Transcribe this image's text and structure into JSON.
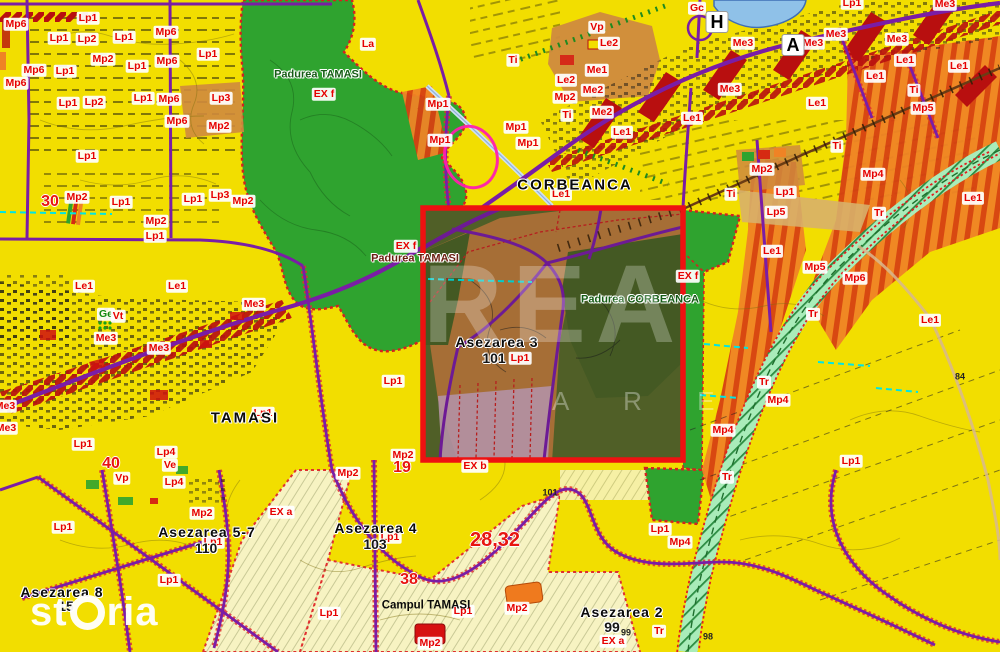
{
  "map_title": "Zoning map Corbeanca / Tamasi with highlighted selection area",
  "colors": {
    "base_yellow": "#f2de00",
    "pale_parcel": "#f7f3c2",
    "forest_green": "#2fa32f",
    "dark_forest_in_selection": "#4c6428",
    "settlement_orange": "#bb7c3d",
    "zone_orange_striped": "#ef8325",
    "corridor_red_hatch": "#b80f0f",
    "road_purple": "#7a1da6",
    "boundary_red_dashed": "#e03030",
    "rail_corridor_mint": "#a9ecb9",
    "water_blue": "#8fc1e8",
    "selection_red": "#ee1111",
    "zone_label_red": "#e60000",
    "utility_cyan": "#00e5e5",
    "pink_parcel": "#c9a3b8"
  },
  "selection_box": {
    "x": 423,
    "y": 208,
    "width": 260,
    "height": 252,
    "color": "#ee1111"
  },
  "watermarks": {
    "storia_prefix": "st",
    "storia_suffix": "ria",
    "storia_full": "storia",
    "rea_main": "REA",
    "rea_sub": "A R E"
  },
  "labels": [
    [
      "Mp6",
      16,
      24,
      "zone"
    ],
    [
      "Mp6",
      166,
      32,
      "zone"
    ],
    [
      "Mp6",
      34,
      70,
      "zone"
    ],
    [
      "Mp6",
      167,
      61,
      "zone"
    ],
    [
      "Mp6",
      16,
      83,
      "zone"
    ],
    [
      "Mp6",
      169,
      99,
      "zone"
    ],
    [
      "Mp6",
      177,
      121,
      "zone"
    ],
    [
      "Mp6",
      855,
      278,
      "zone"
    ],
    [
      "Lp1",
      88,
      18,
      "zone"
    ],
    [
      "Lp1",
      59,
      38,
      "zone"
    ],
    [
      "Lp1",
      124,
      37,
      "zone"
    ],
    [
      "Lp1",
      208,
      54,
      "zone"
    ],
    [
      "Lp1",
      137,
      66,
      "zone"
    ],
    [
      "Lp1",
      65,
      71,
      "zone"
    ],
    [
      "Lp1",
      68,
      103,
      "zone"
    ],
    [
      "Lp1",
      143,
      98,
      "zone"
    ],
    [
      "Lp1",
      87,
      156,
      "zone"
    ],
    [
      "Lp1",
      121,
      202,
      "zone"
    ],
    [
      "Lp1",
      193,
      199,
      "zone"
    ],
    [
      "Lp1",
      155,
      236,
      "zone"
    ],
    [
      "Lp1",
      852,
      3,
      "zone"
    ],
    [
      "Lp1",
      785,
      192,
      "zone"
    ],
    [
      "Lp1",
      393,
      381,
      "zone"
    ],
    [
      "Lp1",
      263,
      413,
      "zone"
    ],
    [
      "Lp1",
      83,
      444,
      "zone"
    ],
    [
      "Lp1",
      63,
      527,
      "zone"
    ],
    [
      "Lp1",
      213,
      542,
      "zone"
    ],
    [
      "Lp1",
      169,
      580,
      "zone"
    ],
    [
      "Lp1",
      329,
      613,
      "zone"
    ],
    [
      "Lp1",
      390,
      537,
      "zone"
    ],
    [
      "Lp1",
      463,
      611,
      "zone"
    ],
    [
      "Lp1",
      660,
      529,
      "zone"
    ],
    [
      "Lp1",
      851,
      461,
      "zone"
    ],
    [
      "Lp1",
      520,
      358,
      "zone"
    ],
    [
      "Lp2",
      87,
      39,
      "zone"
    ],
    [
      "Lp2",
      94,
      102,
      "zone"
    ],
    [
      "Lp3",
      221,
      98,
      "zone"
    ],
    [
      "Lp3",
      220,
      195,
      "zone"
    ],
    [
      "Lp4",
      166,
      452,
      "zone"
    ],
    [
      "Lp4",
      174,
      482,
      "zone"
    ],
    [
      "Lp5",
      776,
      212,
      "zone"
    ],
    [
      "Mp2",
      103,
      59,
      "zone"
    ],
    [
      "Mp2",
      219,
      126,
      "zone"
    ],
    [
      "Mp2",
      77,
      197,
      "zone"
    ],
    [
      "Mp2",
      243,
      201,
      "zone"
    ],
    [
      "Mp2",
      156,
      221,
      "zone"
    ],
    [
      "Mp2",
      565,
      97,
      "zone"
    ],
    [
      "Mp2",
      762,
      169,
      "zone"
    ],
    [
      "Mp2",
      202,
      513,
      "zone"
    ],
    [
      "Mp2",
      348,
      473,
      "zone"
    ],
    [
      "Mp2",
      403,
      455,
      "zone"
    ],
    [
      "Mp2",
      430,
      643,
      "zone"
    ],
    [
      "Mp2",
      517,
      608,
      "zone"
    ],
    [
      "Mp1",
      438,
      104,
      "zone"
    ],
    [
      "Mp1",
      440,
      140,
      "zone"
    ],
    [
      "Mp1",
      516,
      127,
      "zone"
    ],
    [
      "Mp1",
      528,
      143,
      "zone"
    ],
    [
      "Mp4",
      873,
      174,
      "zone"
    ],
    [
      "Mp4",
      778,
      400,
      "zone"
    ],
    [
      "Mp4",
      723,
      430,
      "zone"
    ],
    [
      "Mp4",
      680,
      542,
      "zone"
    ],
    [
      "Mp5",
      923,
      108,
      "zone"
    ],
    [
      "Mp5",
      815,
      267,
      "zone"
    ],
    [
      "Me1",
      597,
      70,
      "zone"
    ],
    [
      "Me2",
      593,
      90,
      "zone"
    ],
    [
      "Me2",
      602,
      112,
      "zone"
    ],
    [
      "Me3",
      945,
      4,
      "zone"
    ],
    [
      "Me3",
      836,
      34,
      "zone"
    ],
    [
      "Me3",
      897,
      39,
      "zone"
    ],
    [
      "Me3",
      813,
      43,
      "zone"
    ],
    [
      "Me3",
      743,
      43,
      "zone"
    ],
    [
      "Me3",
      730,
      89,
      "zone"
    ],
    [
      "Me3",
      254,
      304,
      "zone"
    ],
    [
      "Me3",
      106,
      338,
      "zone"
    ],
    [
      "Me3",
      159,
      348,
      "zone"
    ],
    [
      "Me3",
      5,
      406,
      "zone"
    ],
    [
      "Me3",
      6,
      428,
      "zone"
    ],
    [
      "Le1",
      692,
      118,
      "zone"
    ],
    [
      "Le1",
      622,
      132,
      "zone"
    ],
    [
      "Le1",
      905,
      60,
      "zone"
    ],
    [
      "Le1",
      959,
      66,
      "zone"
    ],
    [
      "Le1",
      875,
      76,
      "zone"
    ],
    [
      "Le1",
      817,
      103,
      "zone"
    ],
    [
      "Le1",
      84,
      286,
      "zone"
    ],
    [
      "Le1",
      177,
      286,
      "zone"
    ],
    [
      "Le1",
      561,
      194,
      "zone"
    ],
    [
      "Le1",
      772,
      251,
      "zone"
    ],
    [
      "Le1",
      930,
      320,
      "zone"
    ],
    [
      "Le1",
      973,
      198,
      "zone"
    ],
    [
      "Le2",
      609,
      43,
      "zone"
    ],
    [
      "Le2",
      566,
      80,
      "zone"
    ],
    [
      "Ti",
      513,
      60,
      "zone"
    ],
    [
      "Ti",
      567,
      115,
      "zone"
    ],
    [
      "Ti",
      914,
      90,
      "zone"
    ],
    [
      "Ti",
      837,
      146,
      "zone"
    ],
    [
      "Ti",
      731,
      194,
      "zone"
    ],
    [
      "Tr",
      879,
      213,
      "zone"
    ],
    [
      "Tr",
      813,
      314,
      "zone"
    ],
    [
      "Tr",
      764,
      382,
      "zone"
    ],
    [
      "Tr",
      727,
      477,
      "zone"
    ],
    [
      "Tr",
      659,
      631,
      "zone"
    ],
    [
      "Vp",
      597,
      27,
      "zone"
    ],
    [
      "Vp",
      122,
      478,
      "zone"
    ],
    [
      "Gc",
      697,
      8,
      "zone"
    ],
    [
      "La",
      368,
      44,
      "zone"
    ],
    [
      "Ge",
      106,
      314,
      "zoneg"
    ],
    [
      "Vt",
      118,
      316,
      "zone"
    ],
    [
      "Ve",
      170,
      465,
      "zone"
    ],
    [
      "EX f",
      324,
      94,
      "zone"
    ],
    [
      "EX f",
      406,
      246,
      "zone"
    ],
    [
      "EX f",
      688,
      276,
      "zone"
    ],
    [
      "EX a",
      281,
      512,
      "zone"
    ],
    [
      "EX a",
      613,
      641,
      "zone"
    ],
    [
      "EX b",
      475,
      466,
      "zone"
    ],
    [
      "30",
      50,
      202,
      "bignum"
    ],
    [
      "40",
      111,
      464,
      "bignum"
    ],
    [
      "19",
      402,
      468,
      "bignum"
    ],
    [
      "38",
      409,
      580,
      "bignum"
    ],
    [
      "28,32",
      495,
      540,
      "bignum2"
    ],
    [
      "CORBEANCA",
      575,
      185,
      "place-lg"
    ],
    [
      "TAMASI",
      245,
      418,
      "place-lg"
    ],
    [
      "Asezarea 3",
      497,
      342,
      "place"
    ],
    [
      "Asezarea 4",
      376,
      528,
      "place"
    ],
    [
      "Asezarea 5-7",
      207,
      532,
      "place"
    ],
    [
      "Asezarea 8",
      62,
      592,
      "place"
    ],
    [
      "Asezarea 2",
      622,
      612,
      "place"
    ],
    [
      "Campul TAMASI",
      426,
      606,
      "place2"
    ],
    [
      "101",
      494,
      358,
      "num"
    ],
    [
      "103",
      375,
      544,
      "num"
    ],
    [
      "110",
      206,
      548,
      "num"
    ],
    [
      "99",
      612,
      627,
      "num"
    ],
    [
      "15",
      66,
      606,
      "num"
    ],
    [
      "101",
      550,
      493,
      "numsm"
    ],
    [
      "99",
      626,
      633,
      "numsm"
    ],
    [
      "98",
      708,
      637,
      "numsm"
    ],
    [
      "84",
      960,
      377,
      "numsm"
    ],
    [
      "Padurea TAMASI",
      318,
      75,
      "forest"
    ],
    [
      "Padurea CORBEANCA",
      640,
      300,
      "forest"
    ],
    [
      "Padurea TAMASI",
      415,
      259,
      "forest2"
    ],
    [
      "H",
      717,
      22,
      "marker"
    ],
    [
      "A",
      793,
      45,
      "marker"
    ]
  ]
}
